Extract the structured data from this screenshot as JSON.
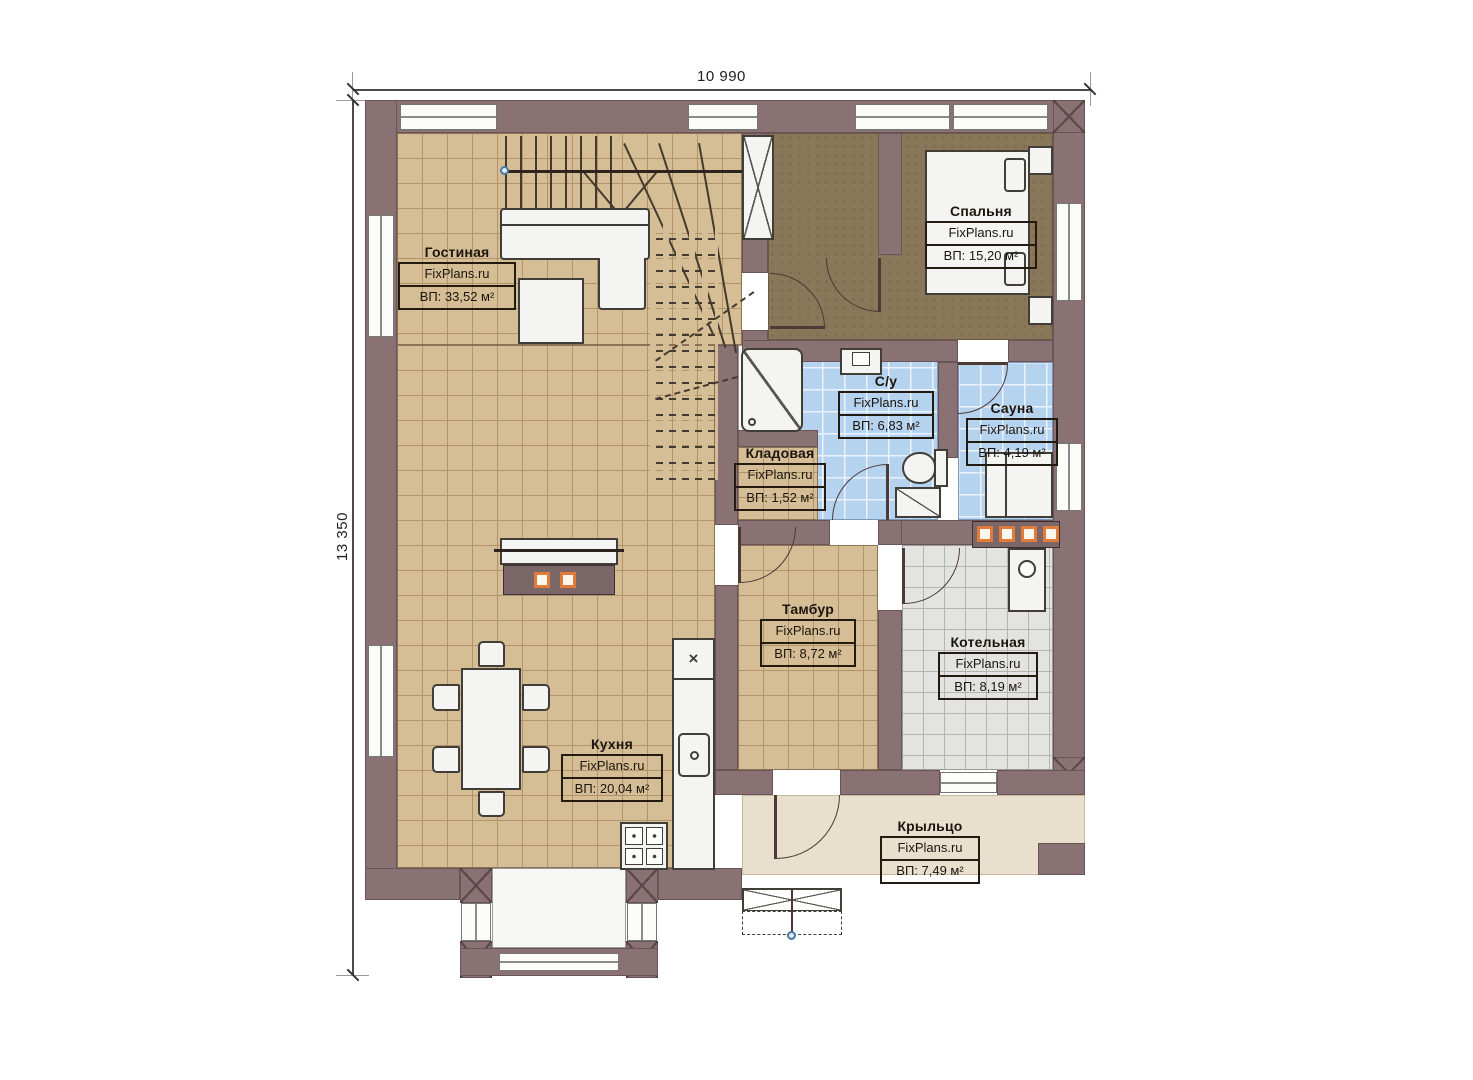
{
  "watermark": "FixPlans.ru",
  "dimensions": {
    "width_label": "10 990",
    "height_label": "13 350"
  },
  "rooms": [
    {
      "name": "Гостиная",
      "area": "ВП: 33,52 м²"
    },
    {
      "name": "Спальня",
      "area": "ВП: 15,20 м²"
    },
    {
      "name": "С/у",
      "area": "ВП: 6,83 м²"
    },
    {
      "name": "Сауна",
      "area": "ВП: 4,19 м²"
    },
    {
      "name": "Кладовая",
      "area": "ВП: 1,52 м²"
    },
    {
      "name": "Тамбур",
      "area": "ВП: 8,72 м²"
    },
    {
      "name": "Котельная",
      "area": "ВП: 8,19 м²"
    },
    {
      "name": "Кухня",
      "area": "ВП: 20,04 м²"
    },
    {
      "name": "Крыльцо",
      "area": "ВП: 7,49 м²"
    }
  ],
  "colors": {
    "wall": "#8a7174",
    "floor_wood": "#d5be96",
    "floor_tile_blue": "#b5d2ef",
    "floor_tile_gray": "#e3e3e1",
    "floor_carpet_brown": "#8a7659",
    "porch": "#e9dfcd",
    "accent_orange": "#e07b39"
  }
}
